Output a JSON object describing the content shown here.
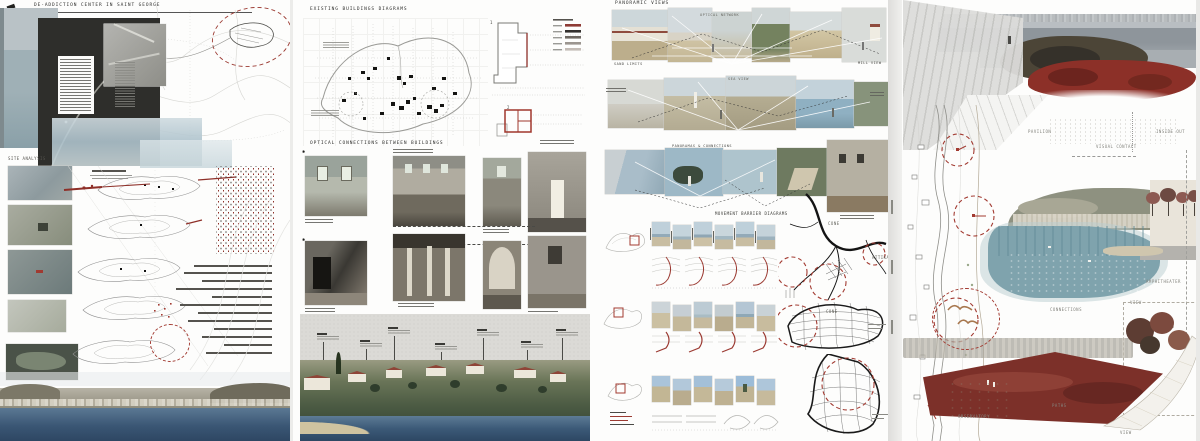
{
  "panels": {
    "p1": {
      "title": "DE-ADDICTION CENTER IN SAINT GEORGE",
      "section": "SITE ANALYSIS"
    },
    "p2": {
      "title": "EXISTING BUILDINGS DIAGRAMS",
      "subtitle": "OPTICAL CONNECTIONS BETWEEN BUILDINGS",
      "marker": "✱",
      "plan_numbers": [
        "1",
        "2"
      ]
    },
    "p3": {
      "title": "PANORAMIC VIEWS",
      "diagram_title": "MOVEMENT BARRIER DIAGRAMS",
      "labels": {
        "optical_network": "OPTICAL NETWORK",
        "sand_limits": "SAND LIMITS",
        "mill_view": "MILL VIEW",
        "sea_view": "SEA VIEW",
        "panoramas_connections": "PANORAMAS & CONNECTIONS",
        "cone_top": "CONE",
        "cone_mid": "CONE",
        "attika": "ATTIKA"
      }
    },
    "p4": {
      "labels": {
        "pavilion": "PAVILION",
        "visual_contact": "VISUAL CONTACT",
        "inside_out": "INSIDE OUT",
        "amphitheater": "AMPHITHEATER",
        "view_mid": "VIEW",
        "seats": "SEATS",
        "connections": "CONNECTIONS",
        "paths": "PATHS",
        "observatory": "OBSERVATORY",
        "view_bottom": "VIEW"
      }
    }
  },
  "colors": {
    "accent_red": "#8e2f28",
    "dash_red": "#a23a31",
    "sea_blue": "#46617c",
    "ink": "#1a1a1a",
    "sketch_gray": "#9a9a9a"
  }
}
